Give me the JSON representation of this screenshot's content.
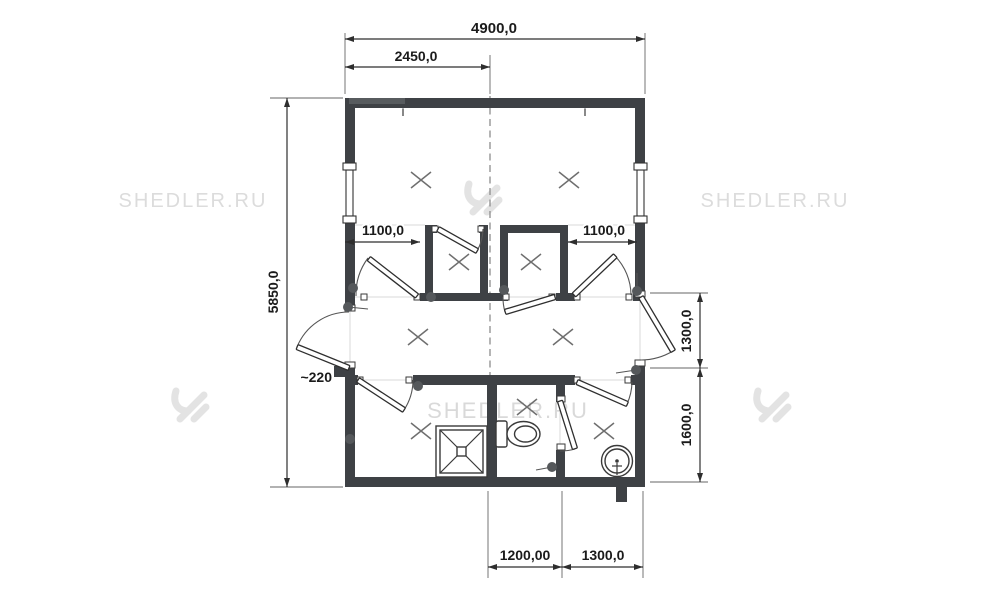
{
  "watermark": {
    "site": "SHEDLER.RU"
  },
  "colors": {
    "wall": "#3e4145",
    "lintel": "#575b5e",
    "dim_text": "#1b1b1b",
    "watermark_gray": "#dcdcdc"
  },
  "dimensions": {
    "overall_width": "4900,0",
    "half_width": "2450,0",
    "overall_depth": "5850,0",
    "left_inset": "1100,0",
    "right_inset": "1100,0",
    "corridor_depth": "1300,0",
    "washroom_depth": "1600,0",
    "wall_thickness_note": "~220",
    "wc_width": "1200,00",
    "sink_room_width": "1300,0"
  }
}
